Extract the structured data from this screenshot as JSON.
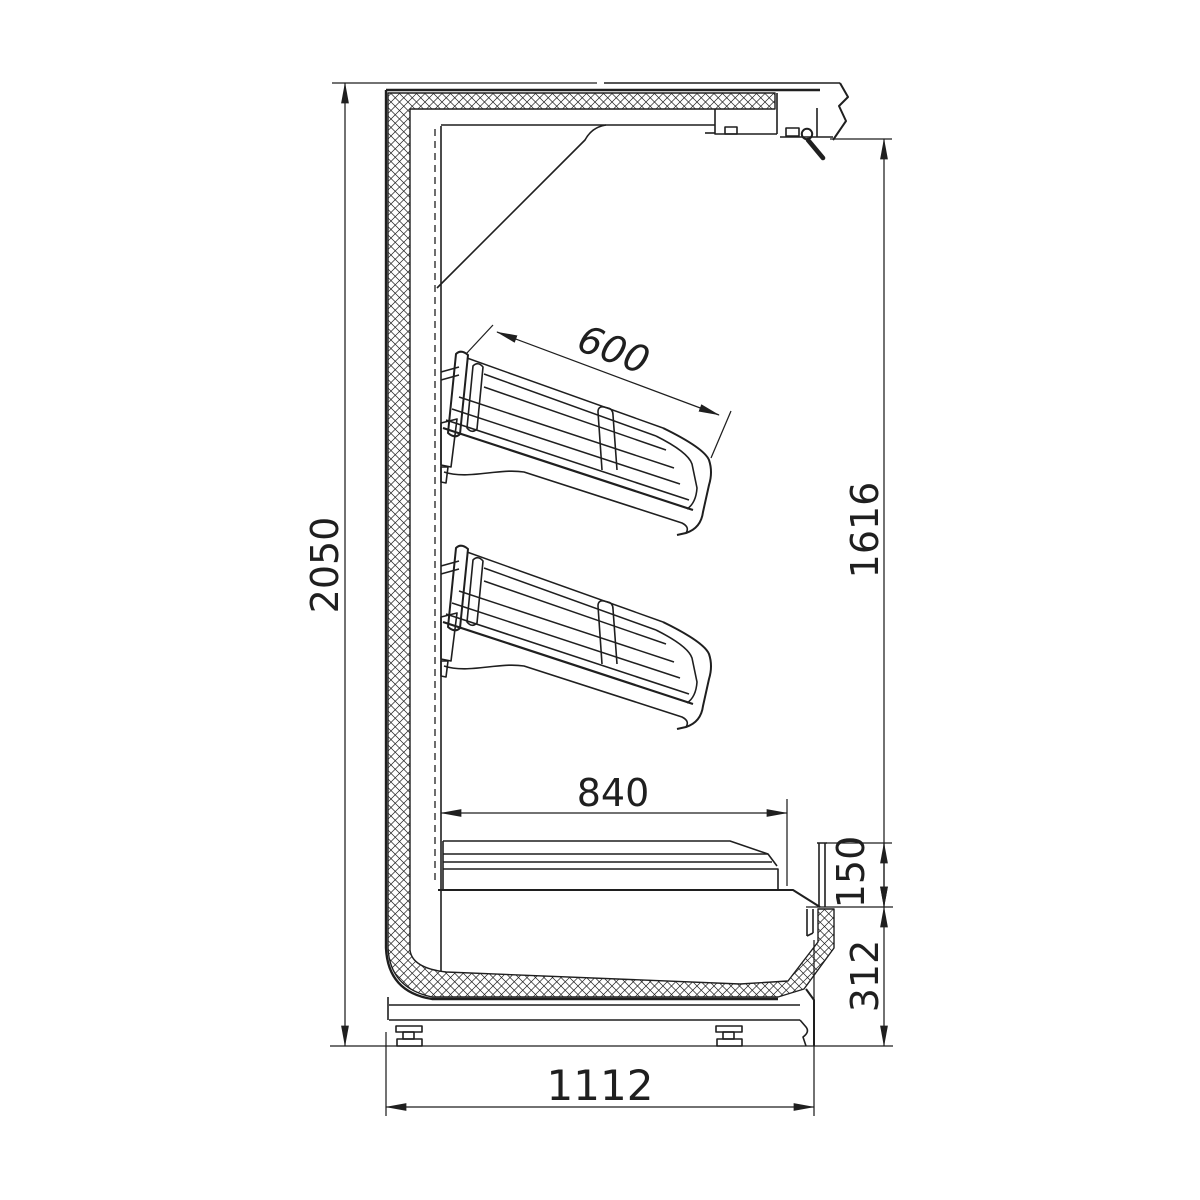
{
  "colors": {
    "line": "#1f1f1f",
    "background": "#ffffff"
  },
  "dims": {
    "overall_height": "2050",
    "shelf_depth": "600",
    "inner_height": "1616",
    "base_shelf_depth": "840",
    "deck_front_height": "150",
    "base_height": "312",
    "overall_depth": "1112"
  }
}
